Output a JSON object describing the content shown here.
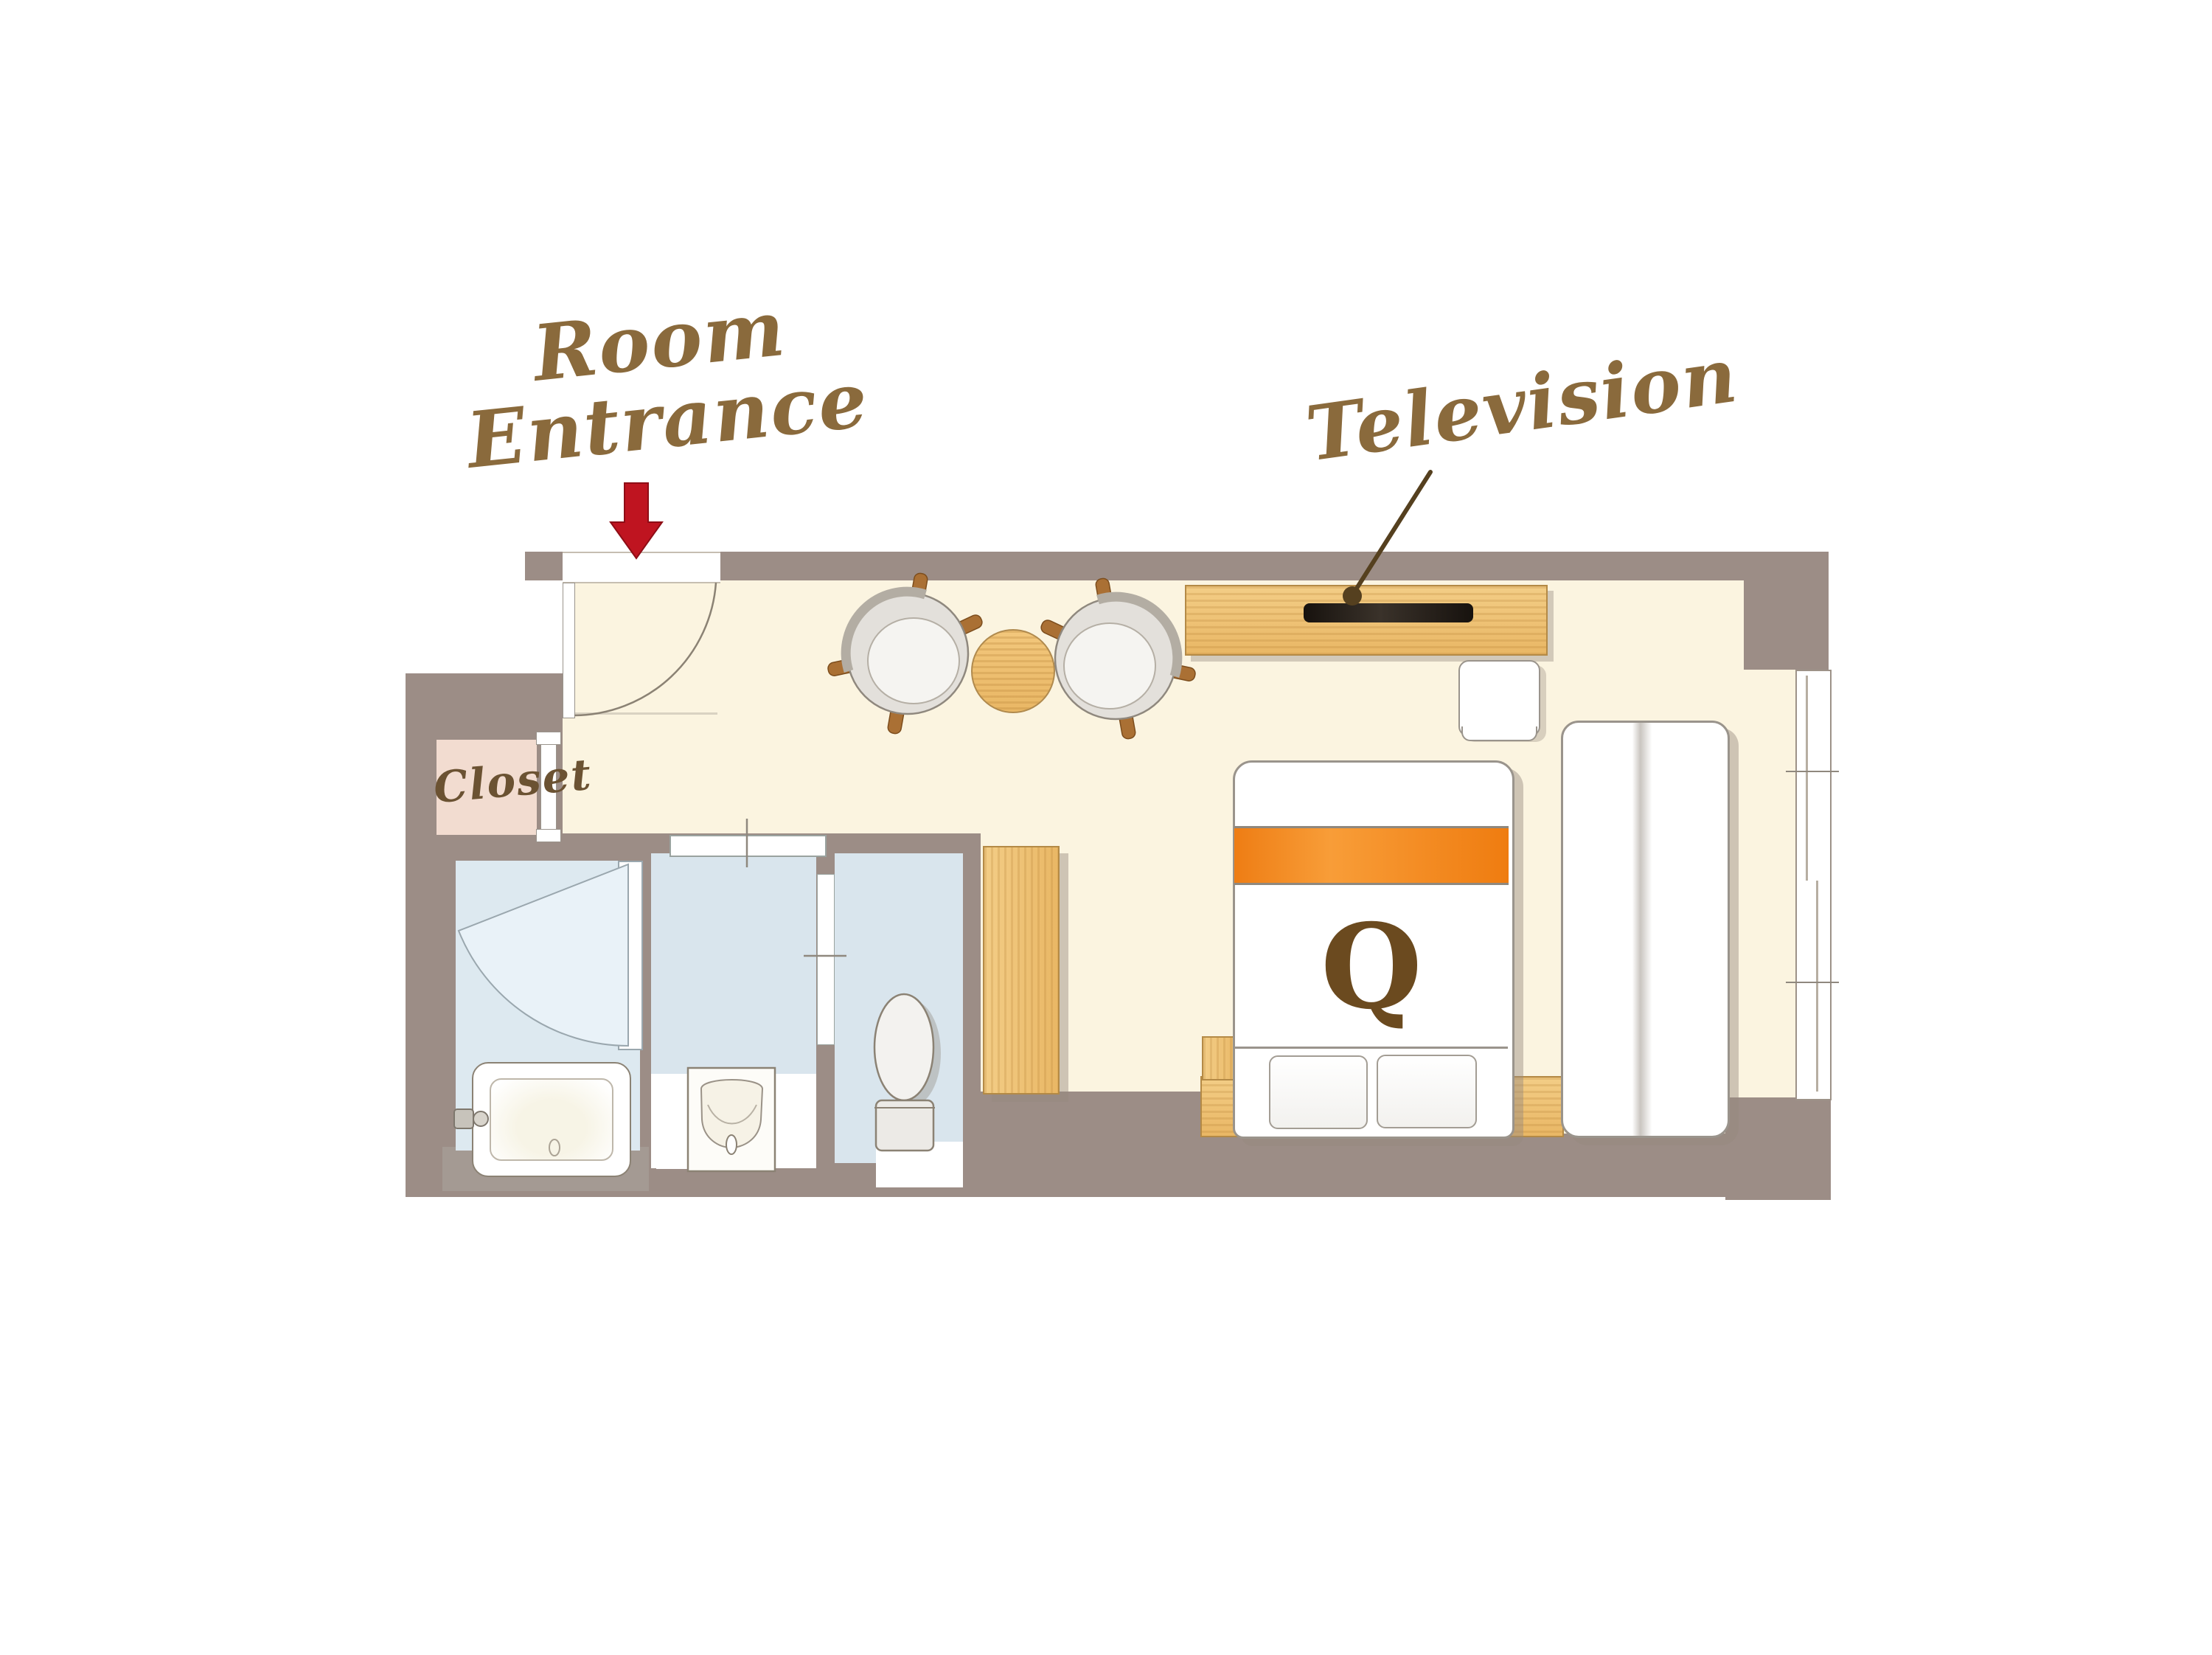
{
  "labels": {
    "room_entrance_line1": "Room",
    "room_entrance_line2": "Entrance",
    "television": "Television",
    "closet": "Closet",
    "bed_type": "Q"
  },
  "icons": {
    "entrance_arrow": "red-down-arrow",
    "television_pointer": "leader-line-with-dot"
  },
  "rooms": [
    "entrance-vestibule",
    "closet",
    "shower-room",
    "vanity-room",
    "toilet-room",
    "bedroom"
  ],
  "furniture": [
    "bathtub",
    "washbasin",
    "toilet",
    "storage-cabinet",
    "tv-console",
    "television",
    "side-stool",
    "dining-chair-left",
    "dining-chair-right",
    "round-table",
    "queen-bed",
    "pillows",
    "headboard",
    "nightstand",
    "sofa-daybed",
    "window"
  ],
  "colors": {
    "wall": "#9c8d86",
    "floor": "#fbf4e0",
    "bathroom_floor": "#d9e5ed",
    "closet_fill": "#f2dcd0",
    "wood": "#eec379",
    "arrow_red": "#bf1420",
    "script_brown": "#8a6a3c",
    "closet_text_brown": "#6b5232",
    "bed_accent_orange": "#f08119",
    "tv_screen_black": "#221c17",
    "exterior_light_gray": "#a59d97"
  }
}
